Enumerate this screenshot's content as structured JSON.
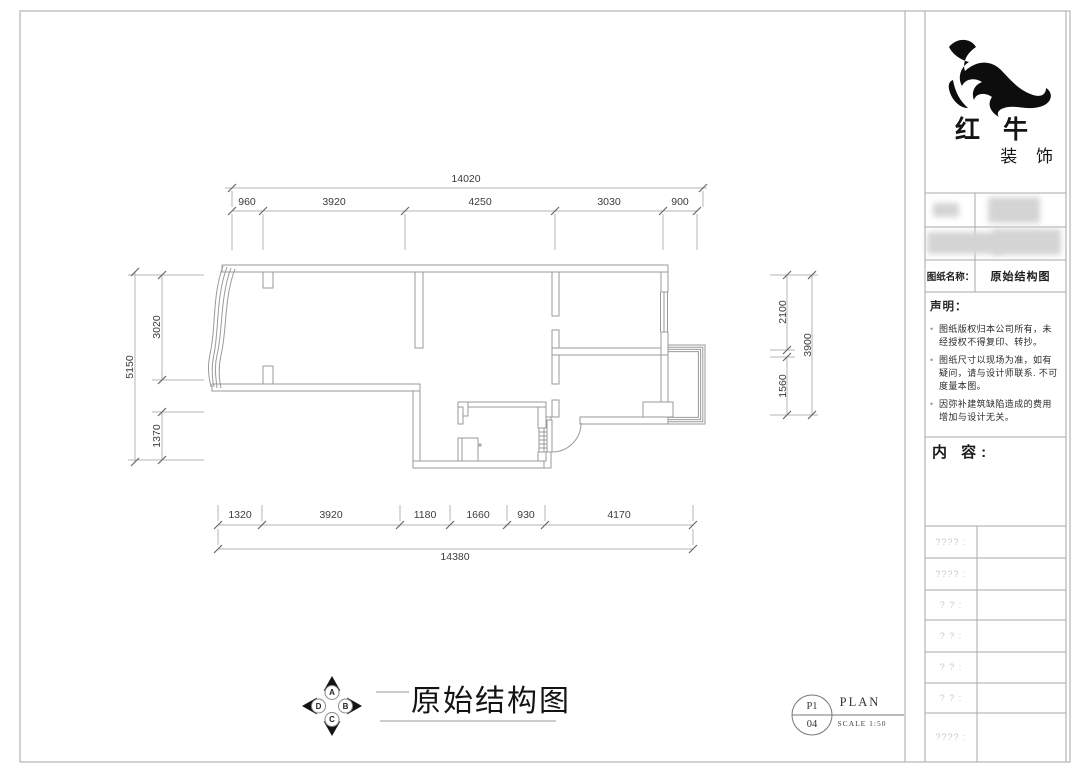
{
  "brand": {
    "name": "红 牛",
    "type": "装 饰"
  },
  "panel": {
    "drawing_name_label": "图纸名称：",
    "drawing_name": "原始结构图",
    "statement": {
      "title": "声明：",
      "items": [
        "图纸版权归本公司所有，未经授权不得复印、转抄。",
        "图纸尺寸以现场为准，如有疑问，请与设计师联系. 不可度量本图。",
        "因弥补建筑缺陷造成的费用增加与设计无关。"
      ]
    },
    "content_label": "内 容:",
    "placeholder_rows": [
      "???? :",
      "???? :",
      "? ? :",
      "? ? :",
      "? ? :",
      "? ? :",
      "???? :"
    ]
  },
  "dimensions": {
    "top_total": "14020",
    "top": [
      "960",
      "3920",
      "4250",
      "3030",
      "900"
    ],
    "bottom": [
      "1320",
      "3920",
      "1180",
      "1660",
      "930",
      "4170"
    ],
    "bottom_total": "14380",
    "left_total": "5150",
    "left": [
      "3020",
      "1370"
    ],
    "right": [
      "2100",
      "1560"
    ],
    "right_total": "3900"
  },
  "footer": {
    "compass": [
      "A",
      "B",
      "C",
      "D"
    ],
    "title": "原始结构图",
    "sheet_top": "P1",
    "sheet_bottom": "04",
    "type_label": "PLAN",
    "scale": "SCALE 1:50"
  }
}
